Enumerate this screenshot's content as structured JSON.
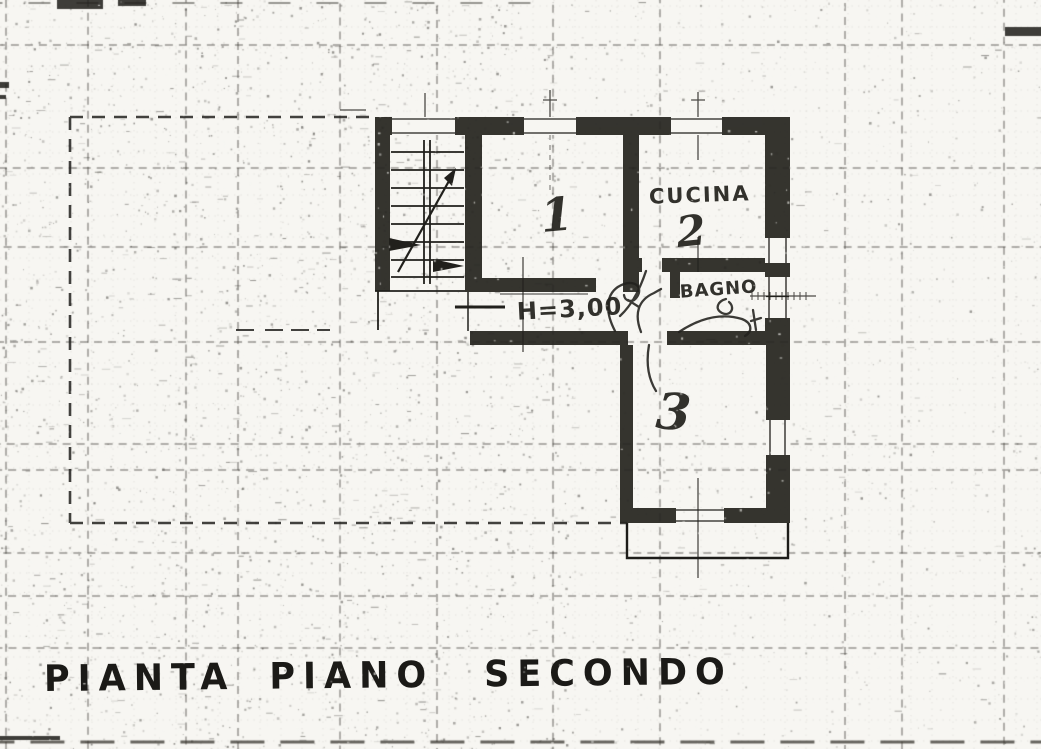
{
  "caption": {
    "word1": "PIANTA",
    "word2": "PIANO",
    "word3": "SECONDO"
  },
  "plan": {
    "room1": {
      "number": "1"
    },
    "kitchen": {
      "label": "CUCINA",
      "number": "2"
    },
    "bathroom": {
      "label": "BAGNO"
    },
    "room3": {
      "number": "3"
    },
    "corridor": {
      "height_annotation": "H=3,00"
    }
  },
  "colors": {
    "paper": "#f7f6f2",
    "ink": "#21201c",
    "wall": "#262520"
  }
}
